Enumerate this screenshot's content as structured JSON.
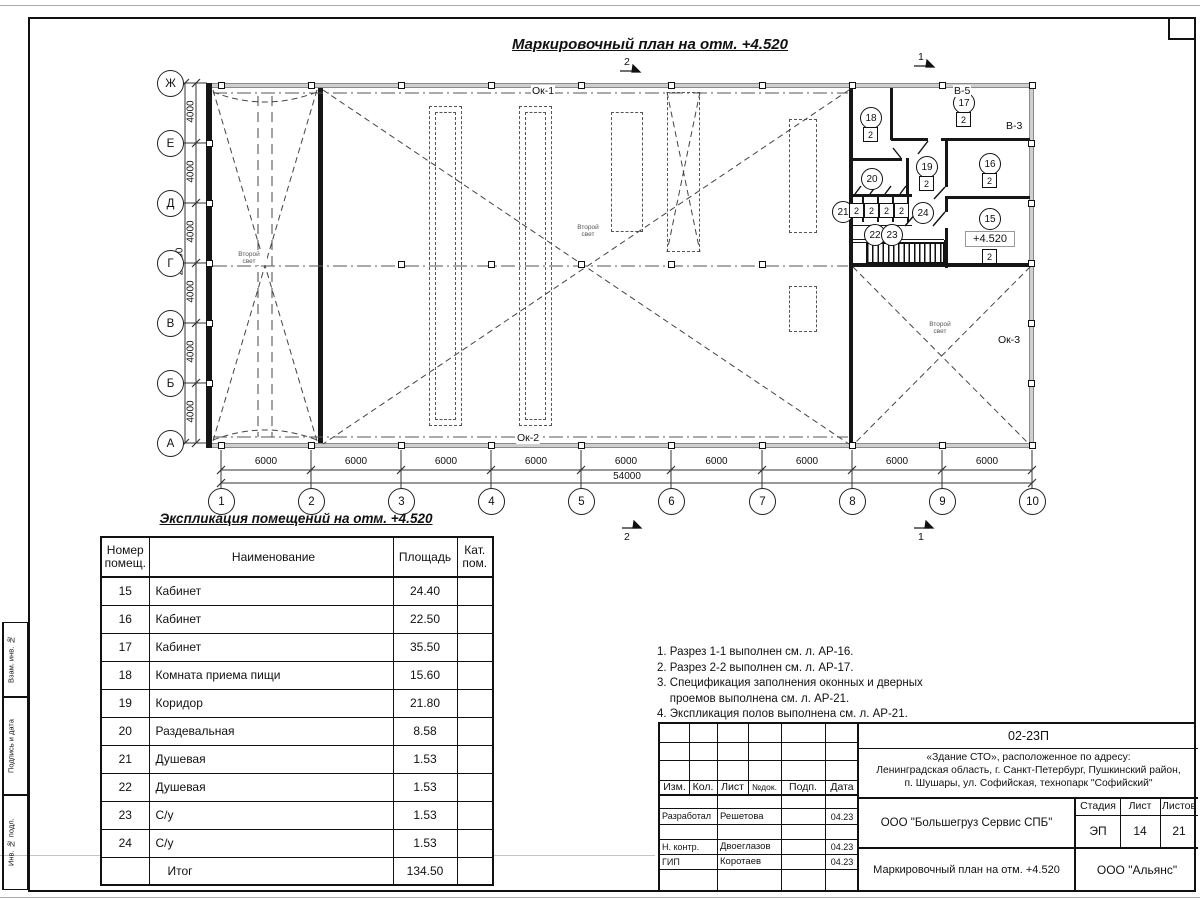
{
  "plan": {
    "title": "Маркировочный план на отм. +4.520",
    "axis_letters": [
      "Ж",
      "Е",
      "Д",
      "Г",
      "В",
      "Б",
      "А"
    ],
    "axis_numbers": [
      "1",
      "2",
      "3",
      "4",
      "5",
      "6",
      "7",
      "8",
      "9",
      "10"
    ],
    "dim_segment_v": "4000",
    "dim_total_v": "24000",
    "dim_segment_h": "6000",
    "dim_total_h": "54000",
    "section_mark_1": "1",
    "section_mark_2": "2",
    "window_top": "Ок-1",
    "window_bottom": "Ок-2",
    "window_right": "Ок-3",
    "door_v5": "В-5",
    "door_v3": "В-3",
    "second_light": "Второй свет",
    "level_mark": "+4.520",
    "rooms": {
      "r15": {
        "num": "15",
        "mark": "2"
      },
      "r16": {
        "num": "16",
        "mark": "2"
      },
      "r17": {
        "num": "17",
        "mark": "2"
      },
      "r18": {
        "num": "18",
        "mark": "2"
      },
      "r19": {
        "num": "19",
        "mark": "2"
      },
      "r20": {
        "num": "20"
      },
      "r21": {
        "num": "21"
      },
      "r22": {
        "num": "22"
      },
      "r23": {
        "num": "23"
      },
      "r24": {
        "num": "24"
      }
    },
    "stall_marks": [
      "2",
      "2",
      "2",
      "2"
    ]
  },
  "schedule": {
    "title": "Экспликация помещений на отм. +4.520",
    "headers": [
      "Номер помещ.",
      "Наименование",
      "Площадь",
      "Кат. пом."
    ],
    "rows": [
      [
        "15",
        "Кабинет",
        "24.40",
        ""
      ],
      [
        "16",
        "Кабинет",
        "22.50",
        ""
      ],
      [
        "17",
        "Кабинет",
        "35.50",
        ""
      ],
      [
        "18",
        "Комната приема пищи",
        "15.60",
        ""
      ],
      [
        "19",
        "Коридор",
        "21.80",
        ""
      ],
      [
        "20",
        "Раздевальная",
        "8.58",
        ""
      ],
      [
        "21",
        "Душевая",
        "1.53",
        ""
      ],
      [
        "22",
        "Душевая",
        "1.53",
        ""
      ],
      [
        "23",
        "С/у",
        "1.53",
        ""
      ],
      [
        "24",
        "С/у",
        "1.53",
        ""
      ]
    ],
    "total": [
      "",
      "Итог",
      "134.50",
      ""
    ]
  },
  "notes": {
    "lines": [
      "1. Разрез 1-1 выполнен см. л. АР-16.",
      "2. Разрез 2-2 выполнен см. л. АР-17.",
      "3. Спецификация заполнения оконных и дверных",
      "    проемов выполнена см. л. АР-21.",
      "4. Экспликация полов выполнена см. л. АР-21."
    ]
  },
  "titleblock": {
    "code": "02-23П",
    "address_lines": [
      "«Здание СТО», расположенное по адресу:",
      "Ленинградская область, г. Санкт-Петербург, Пушкинский район,",
      "п. Шушары, ул. Софийская, технопарк \"Софийский\""
    ],
    "col_izm": "Изм.",
    "col_kol": "Кол.",
    "col_list": "Лист",
    "col_ndok": "№док.",
    "col_podp": "Подп.",
    "col_data": "Дата",
    "roles": [
      {
        "role": "Разработал",
        "name": "Решетова",
        "date": "04.23"
      },
      {
        "role": "Н. контр.",
        "name": "Двоеглазов",
        "date": "04.23"
      },
      {
        "role": "ГИП",
        "name": "Коротаев",
        "date": "04.23"
      }
    ],
    "company": "ООО \"Большегруз Сервис СПБ\"",
    "stage_label": "Стадия",
    "sheet_label": "Лист",
    "sheets_label": "Листов",
    "stage": "ЭП",
    "sheet": "14",
    "sheets": "21",
    "doc_title": "Маркировочный план на отм. +4.520",
    "org": "ООО \"Альянс\""
  },
  "side_stamp": {
    "labels": [
      "Взам. инв. №",
      "Подпись и дата",
      "Инв. № подл."
    ]
  }
}
